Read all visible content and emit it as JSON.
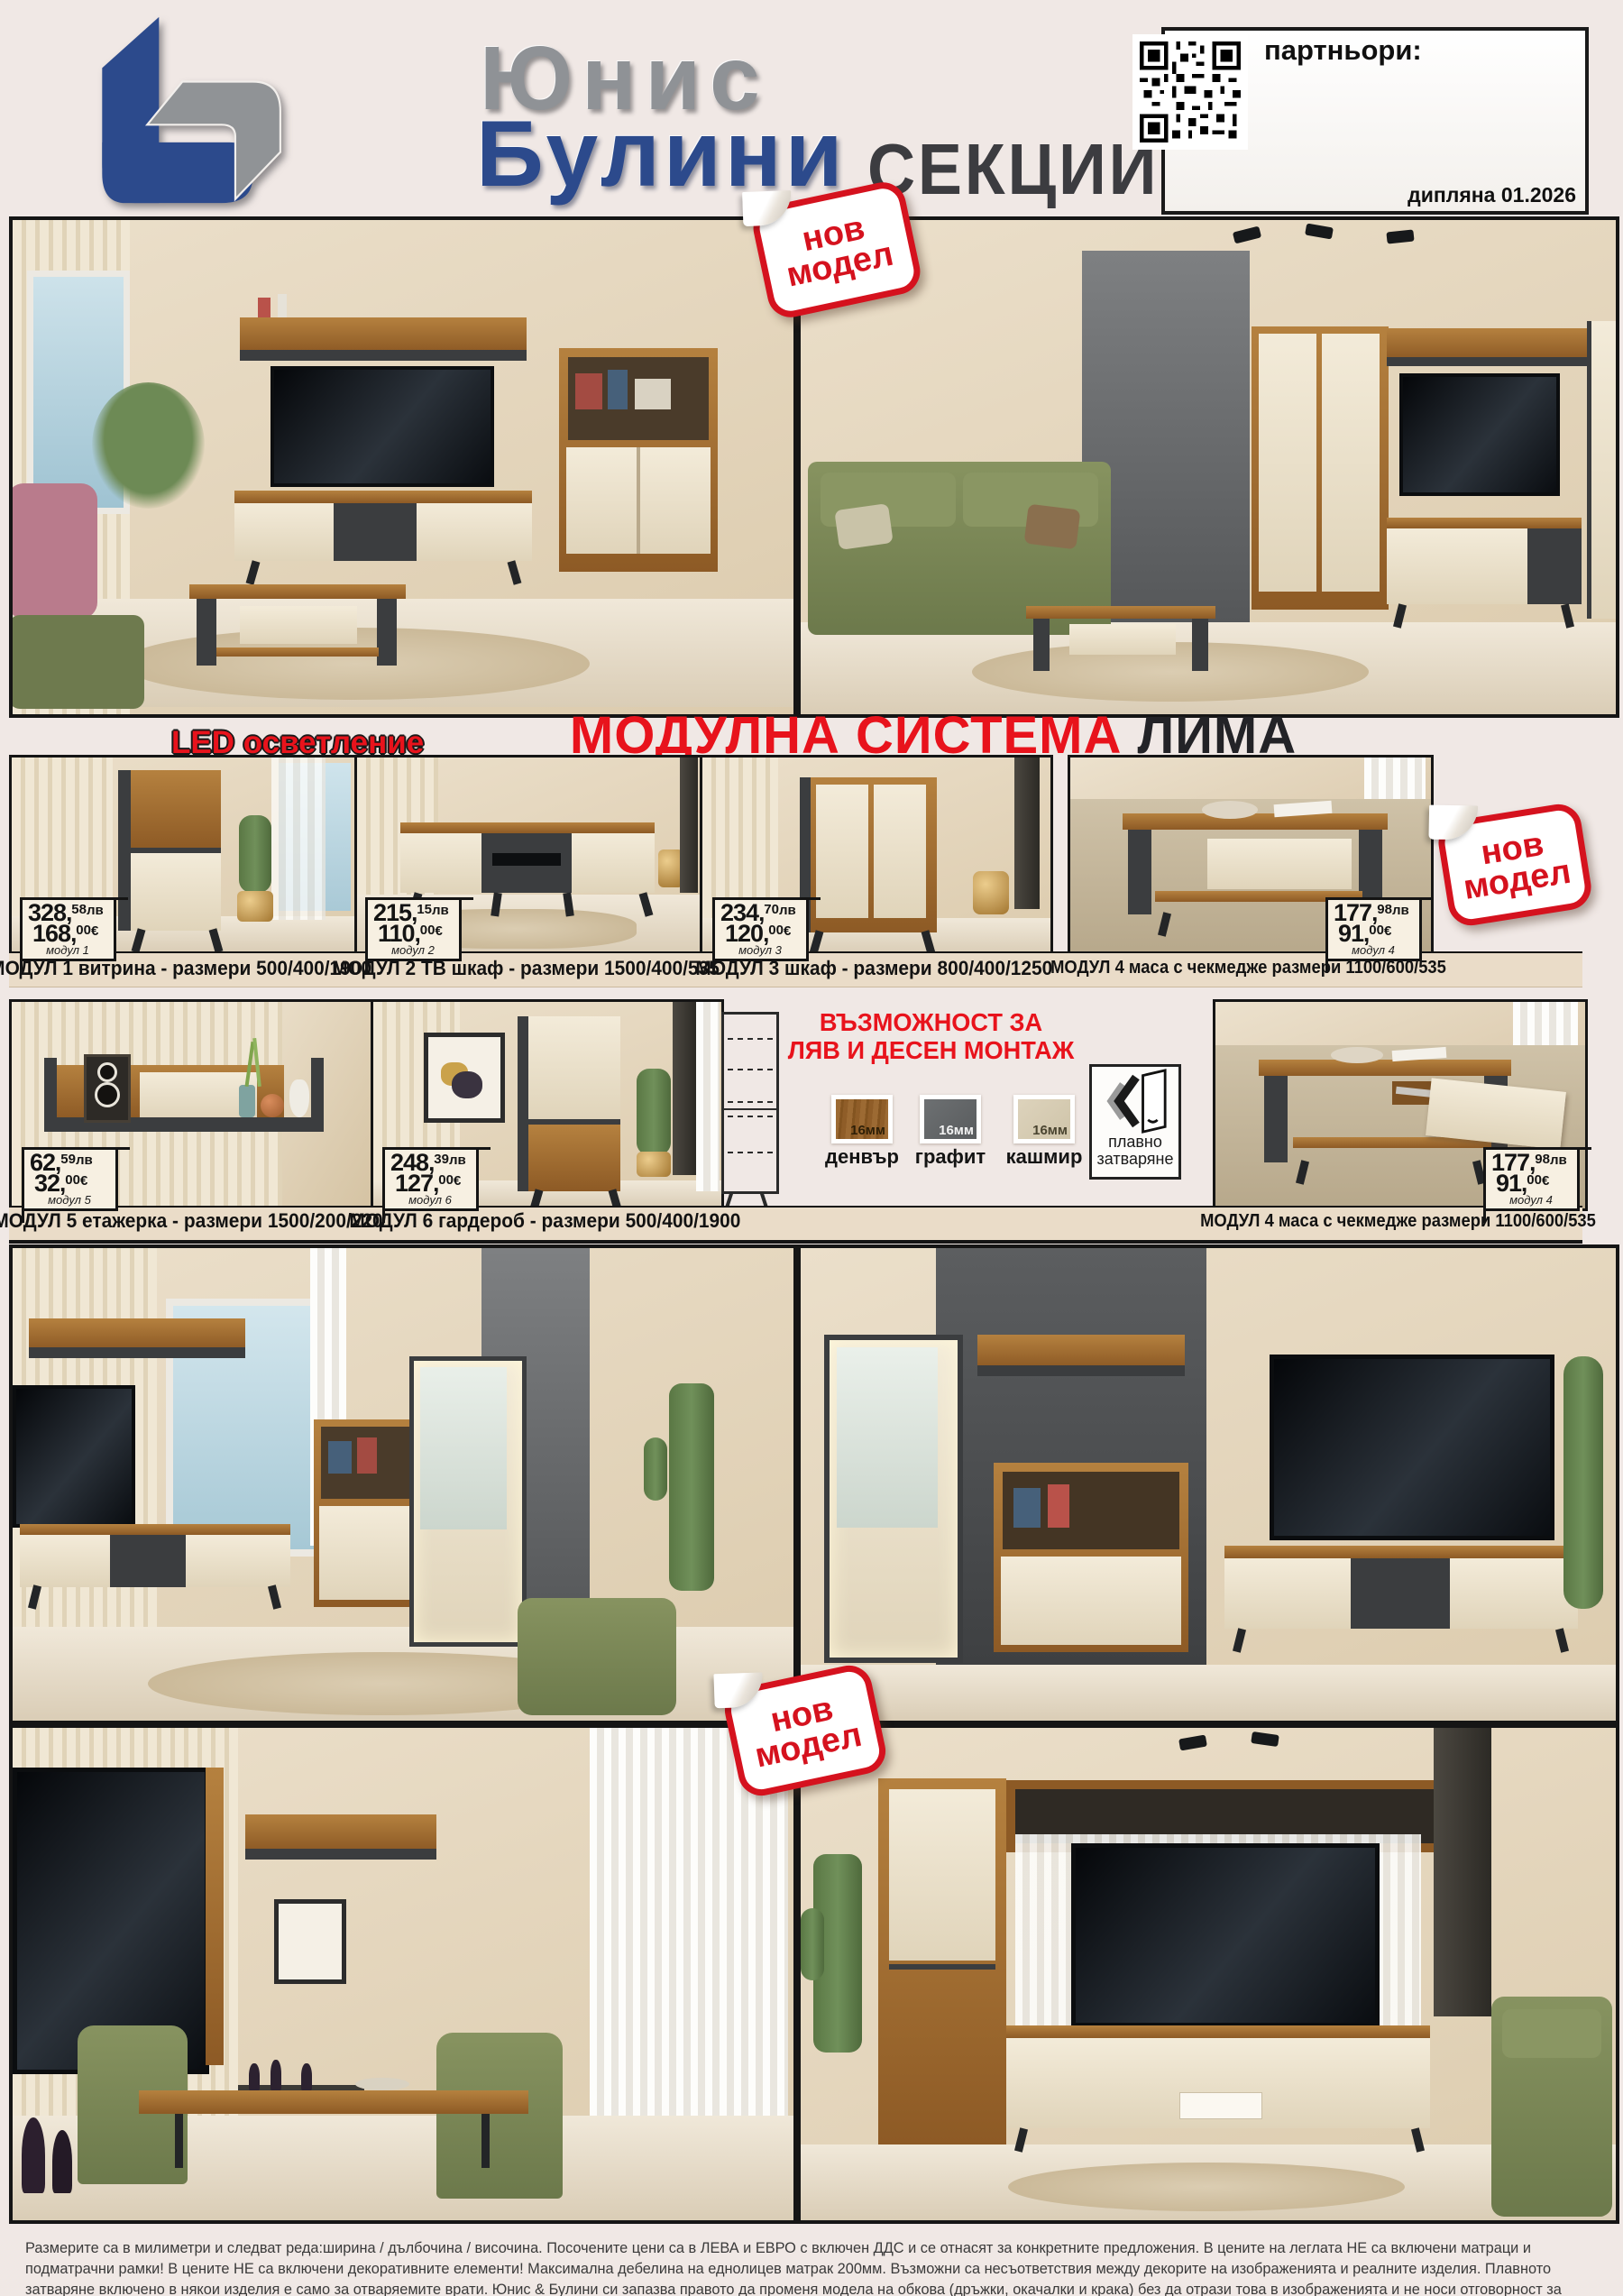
{
  "colors": {
    "page_bg": "#f0e8e5",
    "accent_red": "#e8131c",
    "brand_blue": "#2c4a8c",
    "brand_gray": "#8f9296",
    "caption_bg": "#eadcc8",
    "price_bg": "#f7f0e2"
  },
  "header": {
    "brand_line1": "Юнис",
    "brand_line2": "Булини",
    "page_title": "СЕКЦИИ 1",
    "partners_label": "партньори:",
    "edition_label": "дипляна 01.2026"
  },
  "badge": {
    "line1": "нов",
    "line2": "модел"
  },
  "system": {
    "led_label": "LED осветление",
    "title_red": "МОДУЛНА СИСТЕМА ",
    "title_dark": "ЛИМА"
  },
  "price_labels": {
    "lv": "лв",
    "eur": "€",
    "comma": ","
  },
  "modules": [
    {
      "lv": "328",
      "lv_dec": "58",
      "eur": "168",
      "eur_dec": "00",
      "tag": "модул 1",
      "caption": "МОДУЛ 1 витрина - размери 500/400/1900"
    },
    {
      "lv": "215",
      "lv_dec": "15",
      "eur": "110",
      "eur_dec": "00",
      "tag": "модул 2",
      "caption": "МОДУЛ 2 ТВ шкаф - размери 1500/400/535"
    },
    {
      "lv": "234",
      "lv_dec": "70",
      "eur": "120",
      "eur_dec": "00",
      "tag": "модул 3",
      "caption": "МОДУЛ 3 шкаф - размери 800/400/1250"
    },
    {
      "lv": "177",
      "lv_dec": "98",
      "eur": "91",
      "eur_dec": "00",
      "tag": "модул 4",
      "caption": "МОДУЛ 4 маса с чекмедже  размери 1100/600/535"
    },
    {
      "lv": "62",
      "lv_dec": "59",
      "eur": "32",
      "eur_dec": "00",
      "tag": "модул 5",
      "caption": "МОДУЛ 5 етажерка - размери 1500/200/220"
    },
    {
      "lv": "248",
      "lv_dec": "39",
      "eur": "127",
      "eur_dec": "00",
      "tag": "модул 6",
      "caption": "МОДУЛ 6 гардероб - размери 500/400/1900"
    },
    {
      "lv": "177",
      "lv_dec": "98",
      "eur": "91",
      "eur_dec": "00",
      "tag": "модул 4",
      "caption": "МОДУЛ 4 маса с чекмедже  размери 1100/600/535"
    }
  ],
  "options": {
    "title_line1": "ВЪЗМОЖНОСТ ЗА",
    "title_line2": "ЛЯВ И ДЕСЕН МОНТАЖ",
    "swatches": [
      {
        "thickness": "16мм",
        "name": "денвър"
      },
      {
        "thickness": "16мм",
        "name": "графит"
      },
      {
        "thickness": "16мм",
        "name": "кашмир"
      }
    ],
    "soft_close_line1": "плавно",
    "soft_close_line2": "затваряне"
  },
  "footer": {
    "text": "Размерите са в милиметри и следват реда:ширина / дълбочина / височина. Посочените цени са в ЛЕВА и ЕВРО с включен ДДС и се отнасят за конкретните предложения. В цените на леглата НЕ са включени матраци и подматрачни рамки! В цените НЕ са включени декоративните елементи! Максимална дебелина на еднолицев матрак 200мм. Възможни са несъответствия между декорите на изображенията и реалните изделия. Плавното затваряне включено в някои изделия е само за отваряемите врати. Юнис & Булини си запазва правото да променя модела на  обкова (дръжки, окачалки и крака) без да отрази това в изображенията и не носи отговорност за допуснати печатни грешки!"
  }
}
